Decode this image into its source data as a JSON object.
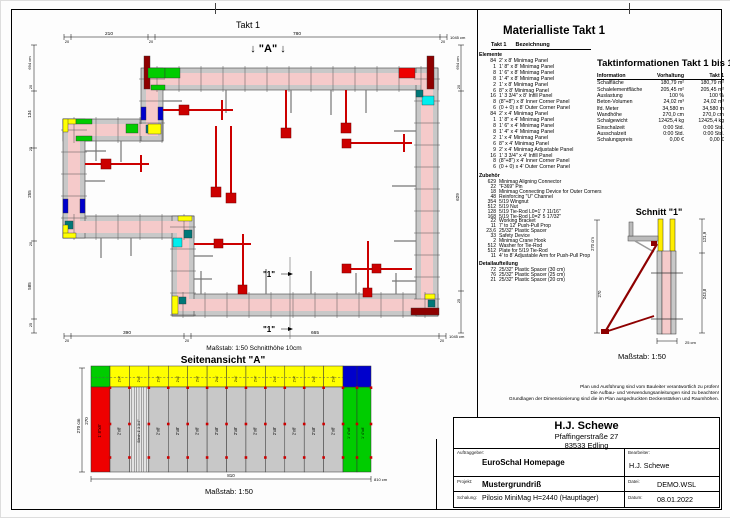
{
  "plan": {
    "title": "Takt 1",
    "marker_a": "↓ \"A\" ↓",
    "cut_label": "\"1\"",
    "scale_note": "Maßstab: 1:50   Schnitthöhe 10cm",
    "dims": {
      "top": [
        "20",
        "210",
        "20",
        "780",
        "20"
      ],
      "top_total": "1045 cm",
      "bottom": [
        "20",
        "390",
        "20",
        "665",
        "20"
      ],
      "bottom_total": "1045 cm",
      "left": [
        "694 cm",
        "20",
        "134",
        "25",
        "255",
        "20",
        "585",
        "25"
      ],
      "right": [
        "694 cm",
        "20",
        "629",
        "25"
      ]
    }
  },
  "side_view": {
    "title": "Seitenansicht \"A\"",
    "scale": "Maßstab: 1:50",
    "dim_bottom": "810",
    "dim_bottom_total": "810 cm",
    "dim_left_total": "270 cm",
    "dim_left": "270",
    "labels": {
      "left_panel": "1' 8\"x8'",
      "gray_panel": "2'x8'",
      "infill_panel": "Blech 1' 3 3/4\"",
      "green_panel": "1' 4\"x8'",
      "top_panel": "2'x4'"
    }
  },
  "schnitt": {
    "title": "Schnitt \"1\"",
    "scale": "Maßstab: 1:50",
    "dim_left_total": "270 cm",
    "dim_left": "270",
    "dim_right_top": "121,9",
    "dim_right_bottom": "243,8",
    "dim_bottom": "25 cm"
  },
  "material_list": {
    "title": "Materialliste  Takt 1",
    "col_takt": "Takt 1",
    "col_name": "Bezeichnung",
    "groups": [
      {
        "label": "Elemente",
        "compact": false,
        "rows": [
          [
            "84",
            "2' x 8' Minimag Panel"
          ],
          [
            "1",
            "1' 8\" x 8' Minimag Panel"
          ],
          [
            "8",
            "1' 6\" x 8' Minimag Panel"
          ],
          [
            "8",
            "1' 4\" x 8' Minimag Panel"
          ],
          [
            "2",
            "1' x 8' Minimag Panel"
          ],
          [
            "6",
            "8\" x 8' Minimag Panel"
          ],
          [
            "16",
            "1' 3 3/4\" x 8' Infill Panel"
          ],
          [
            "8",
            "(8\"+8\") x 8' Inner Corner Panel"
          ],
          [
            "6",
            "(0 + 0) x 8' Outer Corner Panel"
          ],
          [
            "84",
            "2' x 4' Minimag Panel"
          ],
          [
            "1",
            "1' 8\" x 4' Minimag Panel"
          ],
          [
            "8",
            "1' 6\" x 4' Minimag Panel"
          ],
          [
            "8",
            "1' 4\" x 4' Minimag Panel"
          ],
          [
            "2",
            "1' x 4' Minimag Panel"
          ],
          [
            "6",
            "8\" x 4' Minimag Panel"
          ],
          [
            "9",
            "2' x 4' Minimag Adjustable Panel"
          ],
          [
            "16",
            "1' 3 3/4\" x 4' Infill Panel"
          ],
          [
            "8",
            "(8\"+8\") x 4' Inner Corner Panel"
          ],
          [
            "6",
            "(0 + 0) x 4' Outer Corner Panel"
          ]
        ]
      },
      {
        "label": "Zubehör",
        "compact": true,
        "rows": [
          [
            "629",
            "Minimag Aligning Connector"
          ],
          [
            "22",
            "\"F369\" Pin"
          ],
          [
            "18",
            "Minimag Connecting Device for Outer Corners"
          ],
          [
            "48",
            "Reinforcing \"U\" Channel"
          ],
          [
            "354",
            "5/19 Wingnut"
          ],
          [
            "512",
            "5/19 Nut"
          ],
          [
            "128",
            "5/19 Tie-Rod L0=1' 7 11/16\""
          ],
          [
            "168",
            "5/19 Tie-Rod L0=2' 5 17/32\""
          ],
          [
            "22",
            "Working Bracket"
          ],
          [
            "11",
            "7' to 12' Push-Pull Prop"
          ],
          [
            "23,6",
            "25/32\" Plastic Spacer"
          ],
          [
            "33",
            "Safety Device"
          ],
          [
            "2",
            "Minimag Crane Hook"
          ],
          [
            "512",
            "Washer for Tie-Rod"
          ],
          [
            "512",
            "Plate for 5/19 Tie-Rod"
          ],
          [
            "11",
            "4' to 8' Adjustable Arm for Push-Pull Prop"
          ]
        ]
      },
      {
        "label": "Detailaufteilung",
        "compact": true,
        "rows": [
          [
            "72",
            "25/32\" Plastic Spacer (30 cm)"
          ],
          [
            "76",
            "25/32\" Plastic Spacer (25 cm)"
          ],
          [
            "21",
            "25/32\" Plastic Spacer (20 cm)"
          ]
        ]
      }
    ]
  },
  "takt_info": {
    "title": "Taktinformationen  Takt 1 bis 1",
    "headers": [
      "Information",
      "Vorhaltung",
      "Takt 1"
    ],
    "rows": [
      [
        "Schalfläche",
        "180,79 m²",
        "180,79 m²"
      ],
      [
        "Schalelementfläche",
        "205,45 m²",
        "205,45 m²"
      ],
      [
        "Auslastung",
        "100 %",
        "100 %"
      ],
      [
        "Beton-Volumen",
        "24,02 m³",
        "24,02 m³"
      ],
      [
        "lfd. Meter",
        "34,580 m",
        "34,580 m"
      ],
      [
        "Wandhöhe",
        "270,0 cm",
        "270,0 cm"
      ],
      [
        "Schalgewicht",
        "12425,4 kg",
        "12425,4 kg"
      ],
      [
        "Einschalzeit",
        "0:00 Std.",
        "0:00 Std."
      ],
      [
        "Ausschalzeit",
        "0:00 Std.",
        "0:00 Std."
      ],
      [
        "Schalungspreis",
        "0,00 €",
        "0,00 €"
      ]
    ]
  },
  "disclaimer": [
    "Plan und Ausführung sind vom Bauleiter verantwortlich zu prüfen!",
    "Die Aufbau- und Verwendungsanleitungen sind zu beachten!",
    "Grundlagen der Dimensionierung sind die im Plan ausgedruckten Deckenstärken und Raumhöhen."
  ],
  "title_block": {
    "company": "H.J. Schewe",
    "address1": "Pfaffingerstraße 27",
    "address2": "83533 Edling",
    "auftraggeber_label": "Auftraggeber:",
    "auftraggeber": "EuroSchal Homepage",
    "bearbeiter_label": "Bearbeiter:",
    "bearbeiter": "H.J. Schewe",
    "projekt_label": "Projekt:",
    "projekt": "Mustergrundriß",
    "datei_label": "Datei:",
    "datei": "DEMO.WSL",
    "schalung_label": "Schalung:",
    "schalung": "Pilosio MiniMag H=2440 (Hauptlager)",
    "datum_label": "Datum:",
    "datum": "08.01.2022"
  }
}
